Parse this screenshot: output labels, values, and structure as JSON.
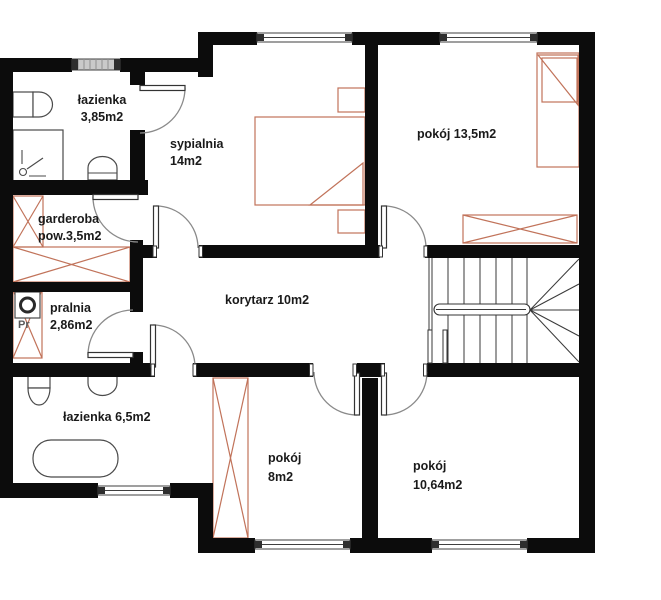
{
  "plan_title": "floor plan",
  "rooms": [
    {
      "id": "lazienka-gorna",
      "line1": "łazienka",
      "line2": "3,85m2",
      "fixtures": [
        "toilet",
        "shower",
        "sink",
        "window"
      ]
    },
    {
      "id": "sypialnia",
      "line1": "sypialnia",
      "line2": "14m2",
      "fixtures": [
        "double-bed",
        "nightstand",
        "nightstand",
        "window"
      ]
    },
    {
      "id": "pokoj-135",
      "line1": "pokój 13,5m2",
      "line2": "",
      "fixtures": [
        "bed",
        "wardrobe",
        "window"
      ]
    },
    {
      "id": "garderoba",
      "line1": "garderoba",
      "line2": "pow.3,5m2",
      "fixtures": [
        "wardrobe",
        "wardrobe"
      ]
    },
    {
      "id": "korytarz",
      "line1": "korytarz 10m2",
      "line2": "",
      "fixtures": [
        "staircase"
      ]
    },
    {
      "id": "pralnia",
      "line1": "pralnia",
      "line2": "2,86m2",
      "fixtures": [
        "washing-machine",
        "cabinet"
      ]
    },
    {
      "id": "lazienka-dolna",
      "line1": "łazienka 6,5m2",
      "line2": "",
      "fixtures": [
        "toilet",
        "sink",
        "bathtub",
        "window"
      ]
    },
    {
      "id": "pokoj-8",
      "line1": "pokój",
      "line2": "8m2",
      "fixtures": [
        "wardrobe",
        "window"
      ]
    },
    {
      "id": "pokoj-1064",
      "line1": "pokój",
      "line2": "10,64m2",
      "fixtures": [
        "window"
      ]
    }
  ],
  "labels": {
    "washer": "Pr"
  },
  "colors": {
    "wall": "#0c0c0c",
    "furniture_outline": "#c1735a",
    "fixture_outline": "#4a4a4a",
    "door_arc": "#8a8a8a",
    "window_frame": "#3f3f3f",
    "window_hatch_fill": "#c9c9c9",
    "text": "#1a1a1a",
    "background": "#ffffff"
  }
}
